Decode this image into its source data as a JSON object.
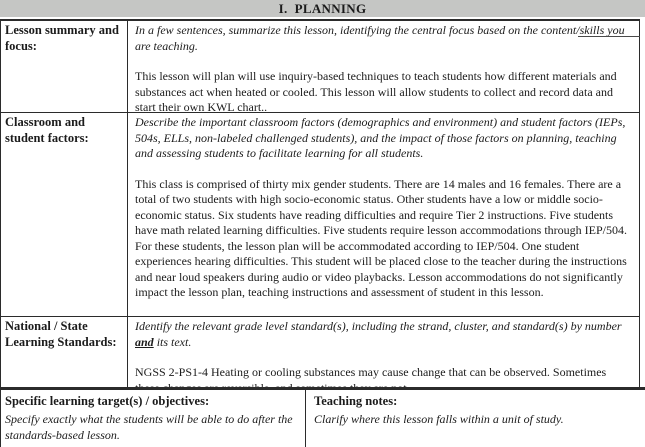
{
  "title": "I.  PLANNING",
  "colors": {
    "header_bg": "#c5c6c4",
    "border": "#2b2b2b",
    "text": "#1b1b1b"
  },
  "rows": [
    {
      "label": "Lesson summary and focus:",
      "prompt": "In a few sentences, summarize this lesson, identifying the central focus based on the content/skills you are teaching.",
      "content": "This lesson will plan will use inquiry-based techniques to teach students how different materials and substances act when heated or cooled. This lesson will allow students to collect and record data and start their own KWL chart.."
    },
    {
      "label": "Classroom and student factors:",
      "prompt": "Describe the important classroom factors (demographics and environment) and student factors (IEPs, 504s, ELLs, non-labeled challenged students), and the impact of those factors on planning, teaching and assessing students to facilitate learning for all students.",
      "content": "This class is comprised of thirty mix gender students. There are 14 males and 16 females. There are a total of two students with high socio-economic status. Other students have a low or middle socio-economic status. Six students have reading difficulties and require Tier 2 instructions. Five students have math related learning difficulties. Five students require lesson accommodations through IEP/504. For these students, the lesson plan will be accommodated according to IEP/504. One student experiences hearing difficulties. This student will be placed close to the teacher during the instructions and near loud speakers during audio or video playbacks.  Lesson accommodations do not significantly impact the lesson plan, teaching instructions and assessment of student in this lesson."
    },
    {
      "label": "National / State Learning Standards:",
      "prompt_before": "Identify the relevant grade level standard(s), including the strand, cluster, and standard(s) by number ",
      "prompt_emph": "and",
      "prompt_after": " its text.",
      "content": "NGSS 2-PS1-4 Heating or cooling substances may cause change that can be observed. Sometimes these changes are reversible, and sometimes they are not."
    }
  ],
  "footer": {
    "left": {
      "heading": "Specific learning target(s) / objectives:",
      "prompt": "Specify exactly what the students will be able to do after the standards-based lesson."
    },
    "right": {
      "heading": "Teaching notes:",
      "prompt": "Clarify where this lesson falls within a unit of study."
    }
  }
}
